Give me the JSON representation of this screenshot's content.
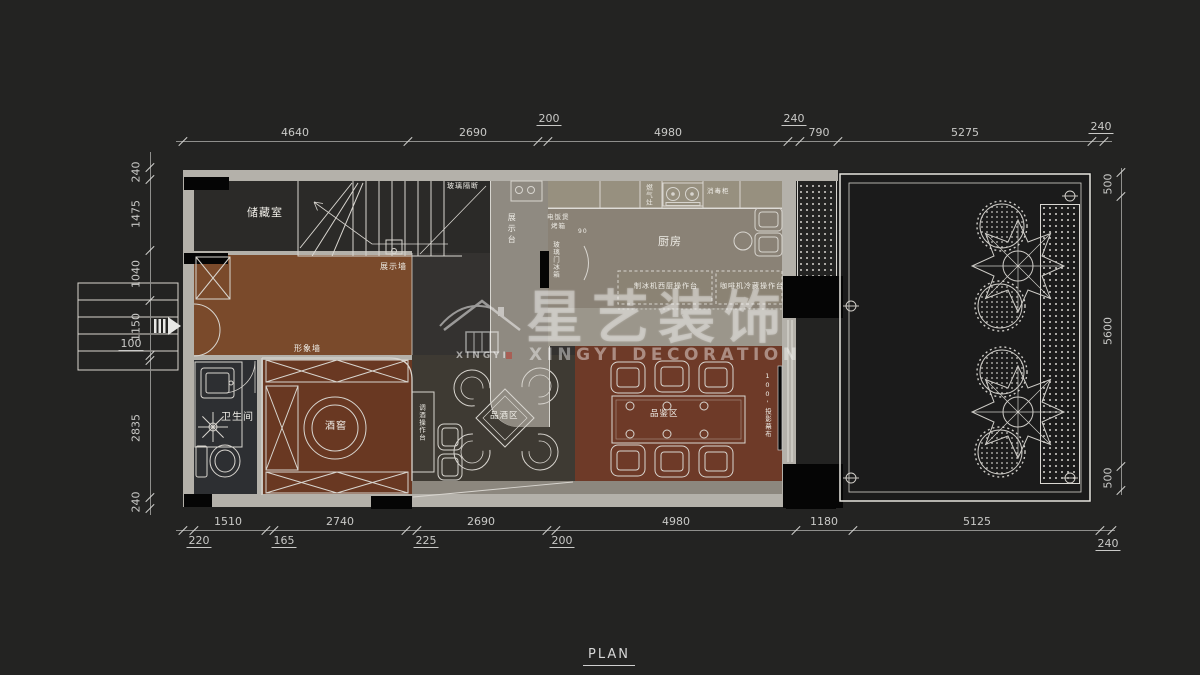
{
  "page": {
    "title": "PLAN"
  },
  "watermark": {
    "brand_cn": "星艺装饰",
    "brand_en": "XINGYI DECORATION",
    "logo_text": "XINGYI"
  },
  "plan_labels": [
    {
      "id": "storage-room",
      "t": "储藏室",
      "x": 247,
      "y": 207,
      "fs": 11
    },
    {
      "id": "kitchen",
      "t": "厨房",
      "x": 658,
      "y": 236,
      "fs": 11
    },
    {
      "id": "bathroom",
      "t": "卫生间",
      "x": 221,
      "y": 412,
      "fs": 10
    },
    {
      "id": "wine-cellar",
      "t": "酒窖",
      "x": 325,
      "y": 421,
      "fs": 10
    },
    {
      "id": "tasting-area",
      "t": "品酒区",
      "x": 490,
      "y": 412,
      "fs": 8.5
    },
    {
      "id": "sampling-area",
      "t": "品鉴区",
      "x": 650,
      "y": 410,
      "fs": 8.5
    },
    {
      "id": "display-wall",
      "t": "展示墙",
      "x": 380,
      "y": 262,
      "fs": 8
    },
    {
      "id": "image-wall",
      "t": "形象墙",
      "x": 294,
      "y": 344,
      "fs": 8
    },
    {
      "id": "display-counter",
      "t": "展示台",
      "x": 507,
      "y": 213,
      "fs": 8,
      "v": true,
      "ls": 3
    },
    {
      "id": "glass-partition",
      "t": "玻璃隔断",
      "x": 447,
      "y": 182,
      "fs": 7
    },
    {
      "id": "rice-cooker",
      "t": "电饭煲",
      "x": 547,
      "y": 214,
      "fs": 6.5
    },
    {
      "id": "oven",
      "t": "烤箱",
      "x": 551,
      "y": 223,
      "fs": 6.5
    },
    {
      "id": "glass-door-fridge",
      "t": "玻璃门冰箱",
      "x": 551,
      "y": 241,
      "fs": 6.5,
      "v": true
    },
    {
      "id": "gas-stove",
      "t": "燃气灶",
      "x": 644,
      "y": 184,
      "fs": 6.5,
      "v": true
    },
    {
      "id": "sterilizer-cabinet",
      "t": "消毒柜",
      "x": 707,
      "y": 188,
      "fs": 6.5
    },
    {
      "id": "island-west",
      "t": "制冰机西厨操作台",
      "x": 634,
      "y": 282,
      "fs": 7
    },
    {
      "id": "island-coffee",
      "t": "咖啡机冷藏操作台",
      "x": 720,
      "y": 282,
      "fs": 7
    },
    {
      "id": "bar-counter",
      "t": "调酒操作台",
      "x": 417,
      "y": 404,
      "fs": 6.5,
      "v": true
    },
    {
      "id": "projection-screen",
      "t": "100'投影幕布",
      "x": 763,
      "y": 372,
      "fs": 6.5,
      "v": true
    },
    {
      "id": "note-90",
      "t": "90",
      "x": 578,
      "y": 229,
      "fs": 6
    }
  ],
  "dim_chains": [
    {
      "id": "top",
      "orient": "h",
      "line": {
        "x": 176,
        "y": 141,
        "len": 936
      },
      "ticks": [
        183,
        408,
        538,
        548,
        788,
        800,
        838,
        1092,
        1104
      ],
      "label_y": 127,
      "labels": [
        {
          "t": "4640",
          "c": 295
        },
        {
          "t": "2690",
          "c": 473
        },
        {
          "t": "4980",
          "c": 668
        },
        {
          "t": "790",
          "c": 819
        },
        {
          "t": "5275",
          "c": 965
        }
      ],
      "subs": [
        {
          "t": "200",
          "c": 549,
          "y": 113
        },
        {
          "t": "240",
          "c": 794,
          "y": 113
        },
        {
          "t": "240",
          "c": 1101,
          "y": 121
        }
      ]
    },
    {
      "id": "bottom",
      "orient": "h",
      "line": {
        "x": 176,
        "y": 530,
        "len": 939
      },
      "ticks": [
        183,
        194,
        266,
        274,
        406,
        417,
        547,
        556,
        796,
        853,
        1100,
        1112
      ],
      "label_y": 516,
      "labels": [
        {
          "t": "1510",
          "c": 228
        },
        {
          "t": "2740",
          "c": 340
        },
        {
          "t": "2690",
          "c": 481
        },
        {
          "t": "4980",
          "c": 676
        },
        {
          "t": "1180",
          "c": 824
        },
        {
          "t": "5125",
          "c": 977
        }
      ],
      "subs": [
        {
          "t": "220",
          "c": 199,
          "y": 535
        },
        {
          "t": "165",
          "c": 284,
          "y": 535
        },
        {
          "t": "225",
          "c": 426,
          "y": 535
        },
        {
          "t": "200",
          "c": 562,
          "y": 535
        },
        {
          "t": "240",
          "c": 1108,
          "y": 538
        }
      ]
    },
    {
      "id": "left",
      "orient": "v",
      "line": {
        "x": 150,
        "y": 152,
        "len": 363
      },
      "ticks": [
        167,
        179,
        250,
        300,
        355,
        360,
        497,
        508
      ],
      "label_x": 136,
      "labels": [
        {
          "t": "240",
          "c": 172
        },
        {
          "t": "1475",
          "c": 214
        },
        {
          "t": "1040",
          "c": 274
        },
        {
          "t": "1150",
          "c": 327
        },
        {
          "t": "2835",
          "c": 428
        },
        {
          "t": "240",
          "c": 502
        }
      ],
      "subs": [
        {
          "t": "100",
          "c": 344,
          "x": 131
        }
      ]
    },
    {
      "id": "right",
      "orient": "v",
      "line": {
        "x": 1121,
        "y": 168,
        "len": 327
      },
      "ticks": [
        172,
        196,
        466,
        490
      ],
      "label_x": 1108,
      "labels": [
        {
          "t": "500",
          "c": 184
        },
        {
          "t": "5600",
          "c": 331
        },
        {
          "t": "500",
          "c": 478
        }
      ],
      "subs": []
    }
  ]
}
